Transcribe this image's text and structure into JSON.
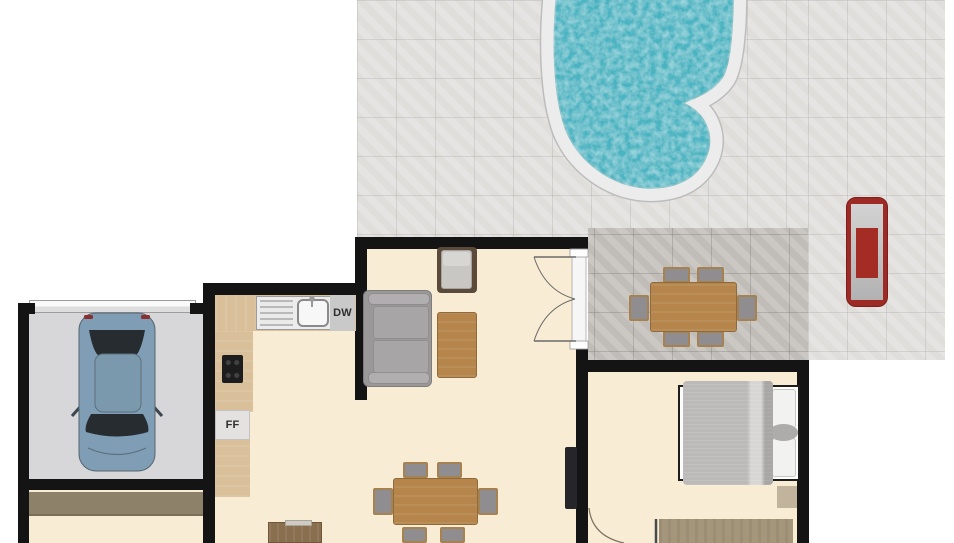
{
  "floorplan": {
    "labels": {
      "dishwasher": "DW",
      "fridge_freezer": "FF"
    },
    "colors": {
      "wall": "#141414",
      "floor": "#f8ecd4",
      "garage_floor": "#d7d7d9",
      "tile": "#e4e3e0",
      "tile_dark": "#c8c5c0",
      "water": "#49b3c1",
      "coping": "#ececec",
      "counter": "#d9c09a",
      "appliance": "#c9c9c9",
      "fridge": "#e3e2e0",
      "sofa": "#9b989a",
      "wood": "#b5854c",
      "chair": "#8f8d90",
      "blanket": "#bcbab8",
      "rug": "#a3967b",
      "mat": "#c2b49c",
      "hall_mat": "#8d8169",
      "lounger": "#9e2a26",
      "car": "#7f9eb5",
      "tv": "#26262a"
    }
  }
}
